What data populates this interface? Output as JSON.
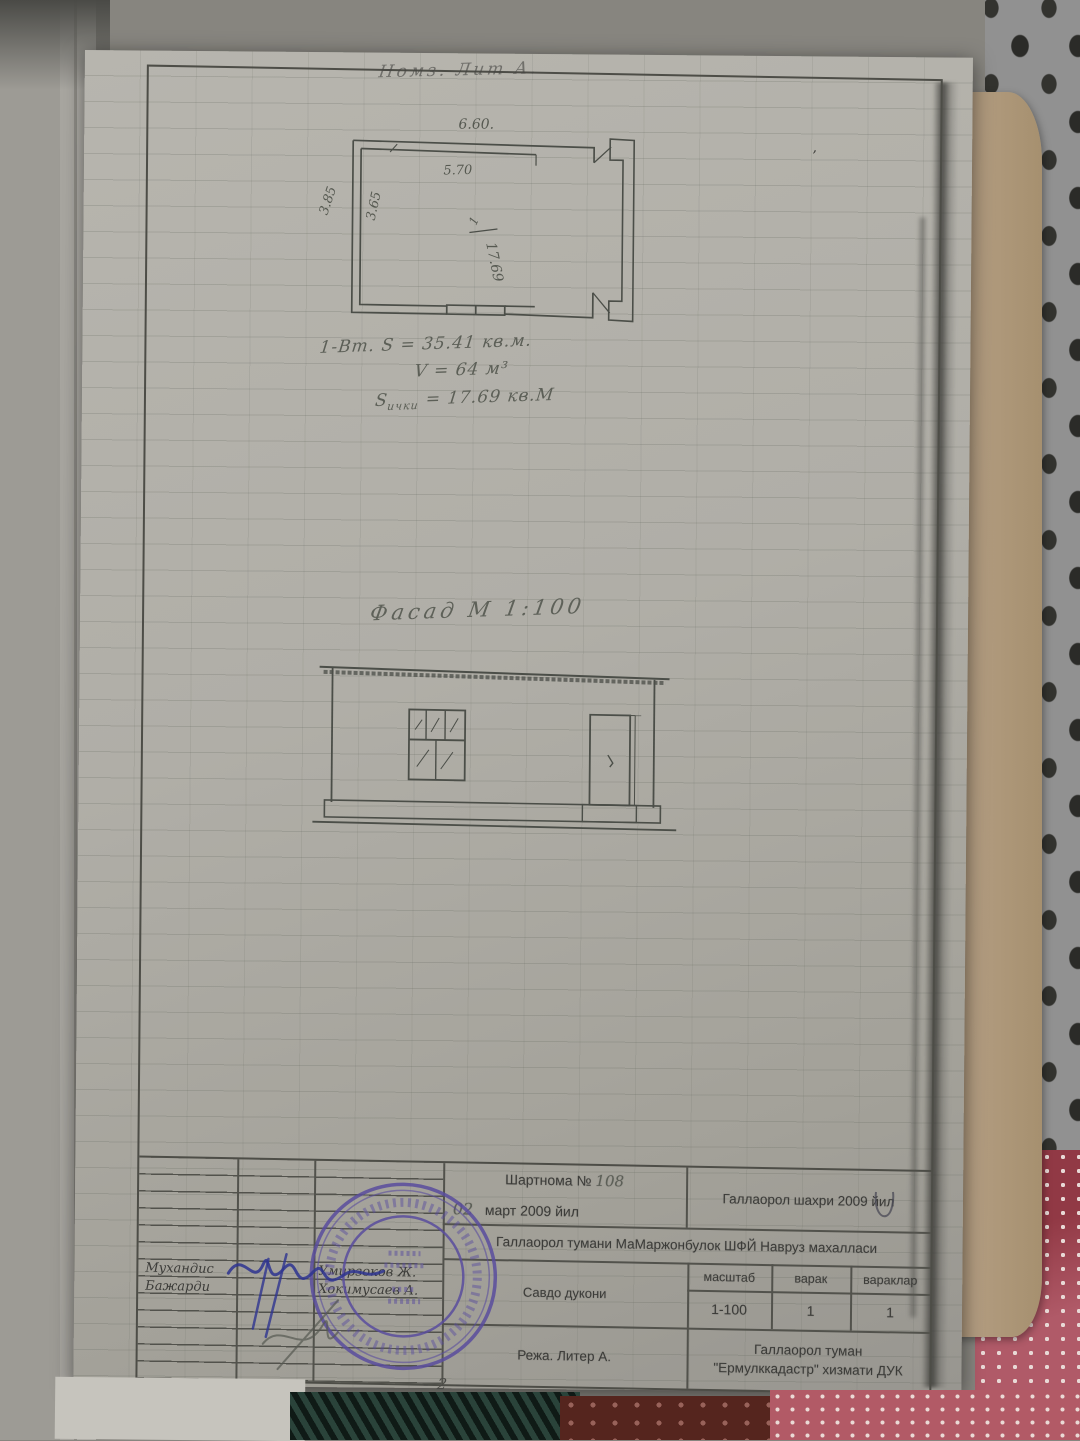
{
  "page": {
    "top_annotation": "Номз.  Лит  А.",
    "page_number": "- 2 -",
    "speck": "’"
  },
  "floor_plan": {
    "dim_top_outer": "6.60.",
    "dim_top_inner": "5.70",
    "dim_left_outer": "3.85",
    "dim_left_inner": "3.65",
    "room_number": "1",
    "room_area": "17.69",
    "notes": {
      "line1": "1-Вт.   S = 35.41 кв.м.",
      "line2": "V = 64 м³",
      "line3_s": "S",
      "line3_sub": "ички",
      "line3_val": " = 17.69 кв.М"
    }
  },
  "facade": {
    "title": "Фасад  М 1:100"
  },
  "title_block": {
    "contract_label": "Шартнома №",
    "contract_number": "108",
    "date_day": "02",
    "date_rest": "март   2009 йил",
    "city": "Галлаорол шахри 2009 йил",
    "district": "Галлаорол  тумани МаМаржонбулок  ШФЙ Навруз махалласи",
    "object": "Савдо  дукони",
    "scale_header": "масштаб",
    "sheet_header": "варак",
    "sheets_header": "вараклар",
    "scale_value": "1-100",
    "sheet_value": "1",
    "sheets_value": "1",
    "plan_label": "Режа.  Литер А.",
    "org_line1": "Галлаорол туман",
    "org_line2": "\"Ермулккадастр\" хизмати ДУК",
    "engineer_label": "Мухандис",
    "engineer_name": "Умирзоков Ж.",
    "executor_label": "Бажарди",
    "executor_name": "Хокимусаев А."
  }
}
